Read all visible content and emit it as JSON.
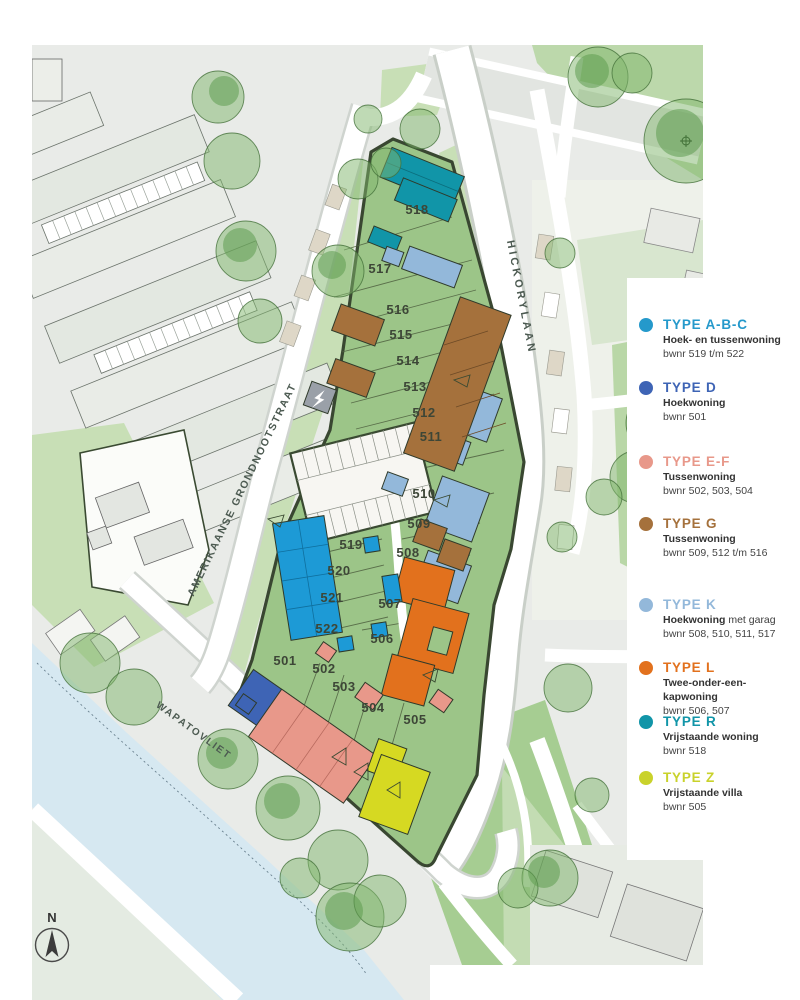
{
  "map": {
    "north_label": "N",
    "streets": [
      {
        "name": "HICKORYLAAN"
      },
      {
        "name": "AMERIKAANSE GRONDNOOTSTRAAT"
      },
      {
        "name": "WAPATOVLIET"
      }
    ],
    "plots": [
      {
        "id": "501",
        "x": 253,
        "y": 620
      },
      {
        "id": "502",
        "x": 292,
        "y": 628
      },
      {
        "id": "503",
        "x": 312,
        "y": 646
      },
      {
        "id": "504",
        "x": 341,
        "y": 667
      },
      {
        "id": "505",
        "x": 383,
        "y": 679
      },
      {
        "id": "506",
        "x": 350,
        "y": 598
      },
      {
        "id": "507",
        "x": 358,
        "y": 563
      },
      {
        "id": "508",
        "x": 376,
        "y": 512
      },
      {
        "id": "509",
        "x": 387,
        "y": 483
      },
      {
        "id": "510",
        "x": 392,
        "y": 453
      },
      {
        "id": "511",
        "x": 399,
        "y": 396
      },
      {
        "id": "512",
        "x": 392,
        "y": 372
      },
      {
        "id": "513",
        "x": 383,
        "y": 346
      },
      {
        "id": "514",
        "x": 376,
        "y": 320
      },
      {
        "id": "515",
        "x": 369,
        "y": 294
      },
      {
        "id": "516",
        "x": 366,
        "y": 269
      },
      {
        "id": "517",
        "x": 348,
        "y": 228
      },
      {
        "id": "518",
        "x": 385,
        "y": 169
      },
      {
        "id": "519",
        "x": 319,
        "y": 504
      },
      {
        "id": "520",
        "x": 307,
        "y": 530
      },
      {
        "id": "521",
        "x": 300,
        "y": 557
      },
      {
        "id": "522",
        "x": 295,
        "y": 588
      }
    ]
  },
  "legend": {
    "items": [
      {
        "label": "TYPE A-B-C",
        "desc": "Hoek- en tussenwoning",
        "desc2": "",
        "bwnr": "bwnr 519 t/m 522",
        "color": "#2599cb"
      },
      {
        "label": "TYPE D",
        "desc": "Hoekwoning",
        "desc2": "",
        "bwnr": "bwnr 501",
        "color": "#3e64b5"
      },
      {
        "label": "TYPE E-F",
        "desc": "Tussenwoning",
        "desc2": "",
        "bwnr": "bwnr 502, 503, 504",
        "color": "#e8988a"
      },
      {
        "label": "TYPE G",
        "desc": "Tussenwoning",
        "desc2": "",
        "bwnr": "bwnr 509, 512 t/m 516",
        "color": "#a5713c"
      },
      {
        "label": "TYPE K",
        "desc": "Hoekwoning",
        "desc2": " met garag",
        "bwnr": "bwnr 508, 510, 511, 517",
        "color": "#93b8da"
      },
      {
        "label": "TYPE L",
        "desc": "Twee-onder-een-kapwoning",
        "desc2": "",
        "bwnr": "bwnr 506, 507",
        "color": "#e2711d"
      },
      {
        "label": "TYPE R",
        "desc": "Vrijstaande woning",
        "desc2": "",
        "bwnr": "bwnr 518",
        "color": "#1195a8"
      },
      {
        "label": "TYPE Z",
        "desc": "Vrijstaande villa",
        "desc2": "",
        "bwnr": "bwnr 505",
        "color": "#c9d22b"
      }
    ]
  },
  "building_colors": {
    "type_abc": "#1d9ad6",
    "type_d": "#3e64b5",
    "type_ef": "#e8988a",
    "type_g": "#a5713c",
    "type_k": "#93b8da",
    "type_l": "#e2711d",
    "type_r": "#1195a8",
    "type_z": "#d6d922",
    "site_green": "#9cc588",
    "water": "#d6e8f1"
  }
}
